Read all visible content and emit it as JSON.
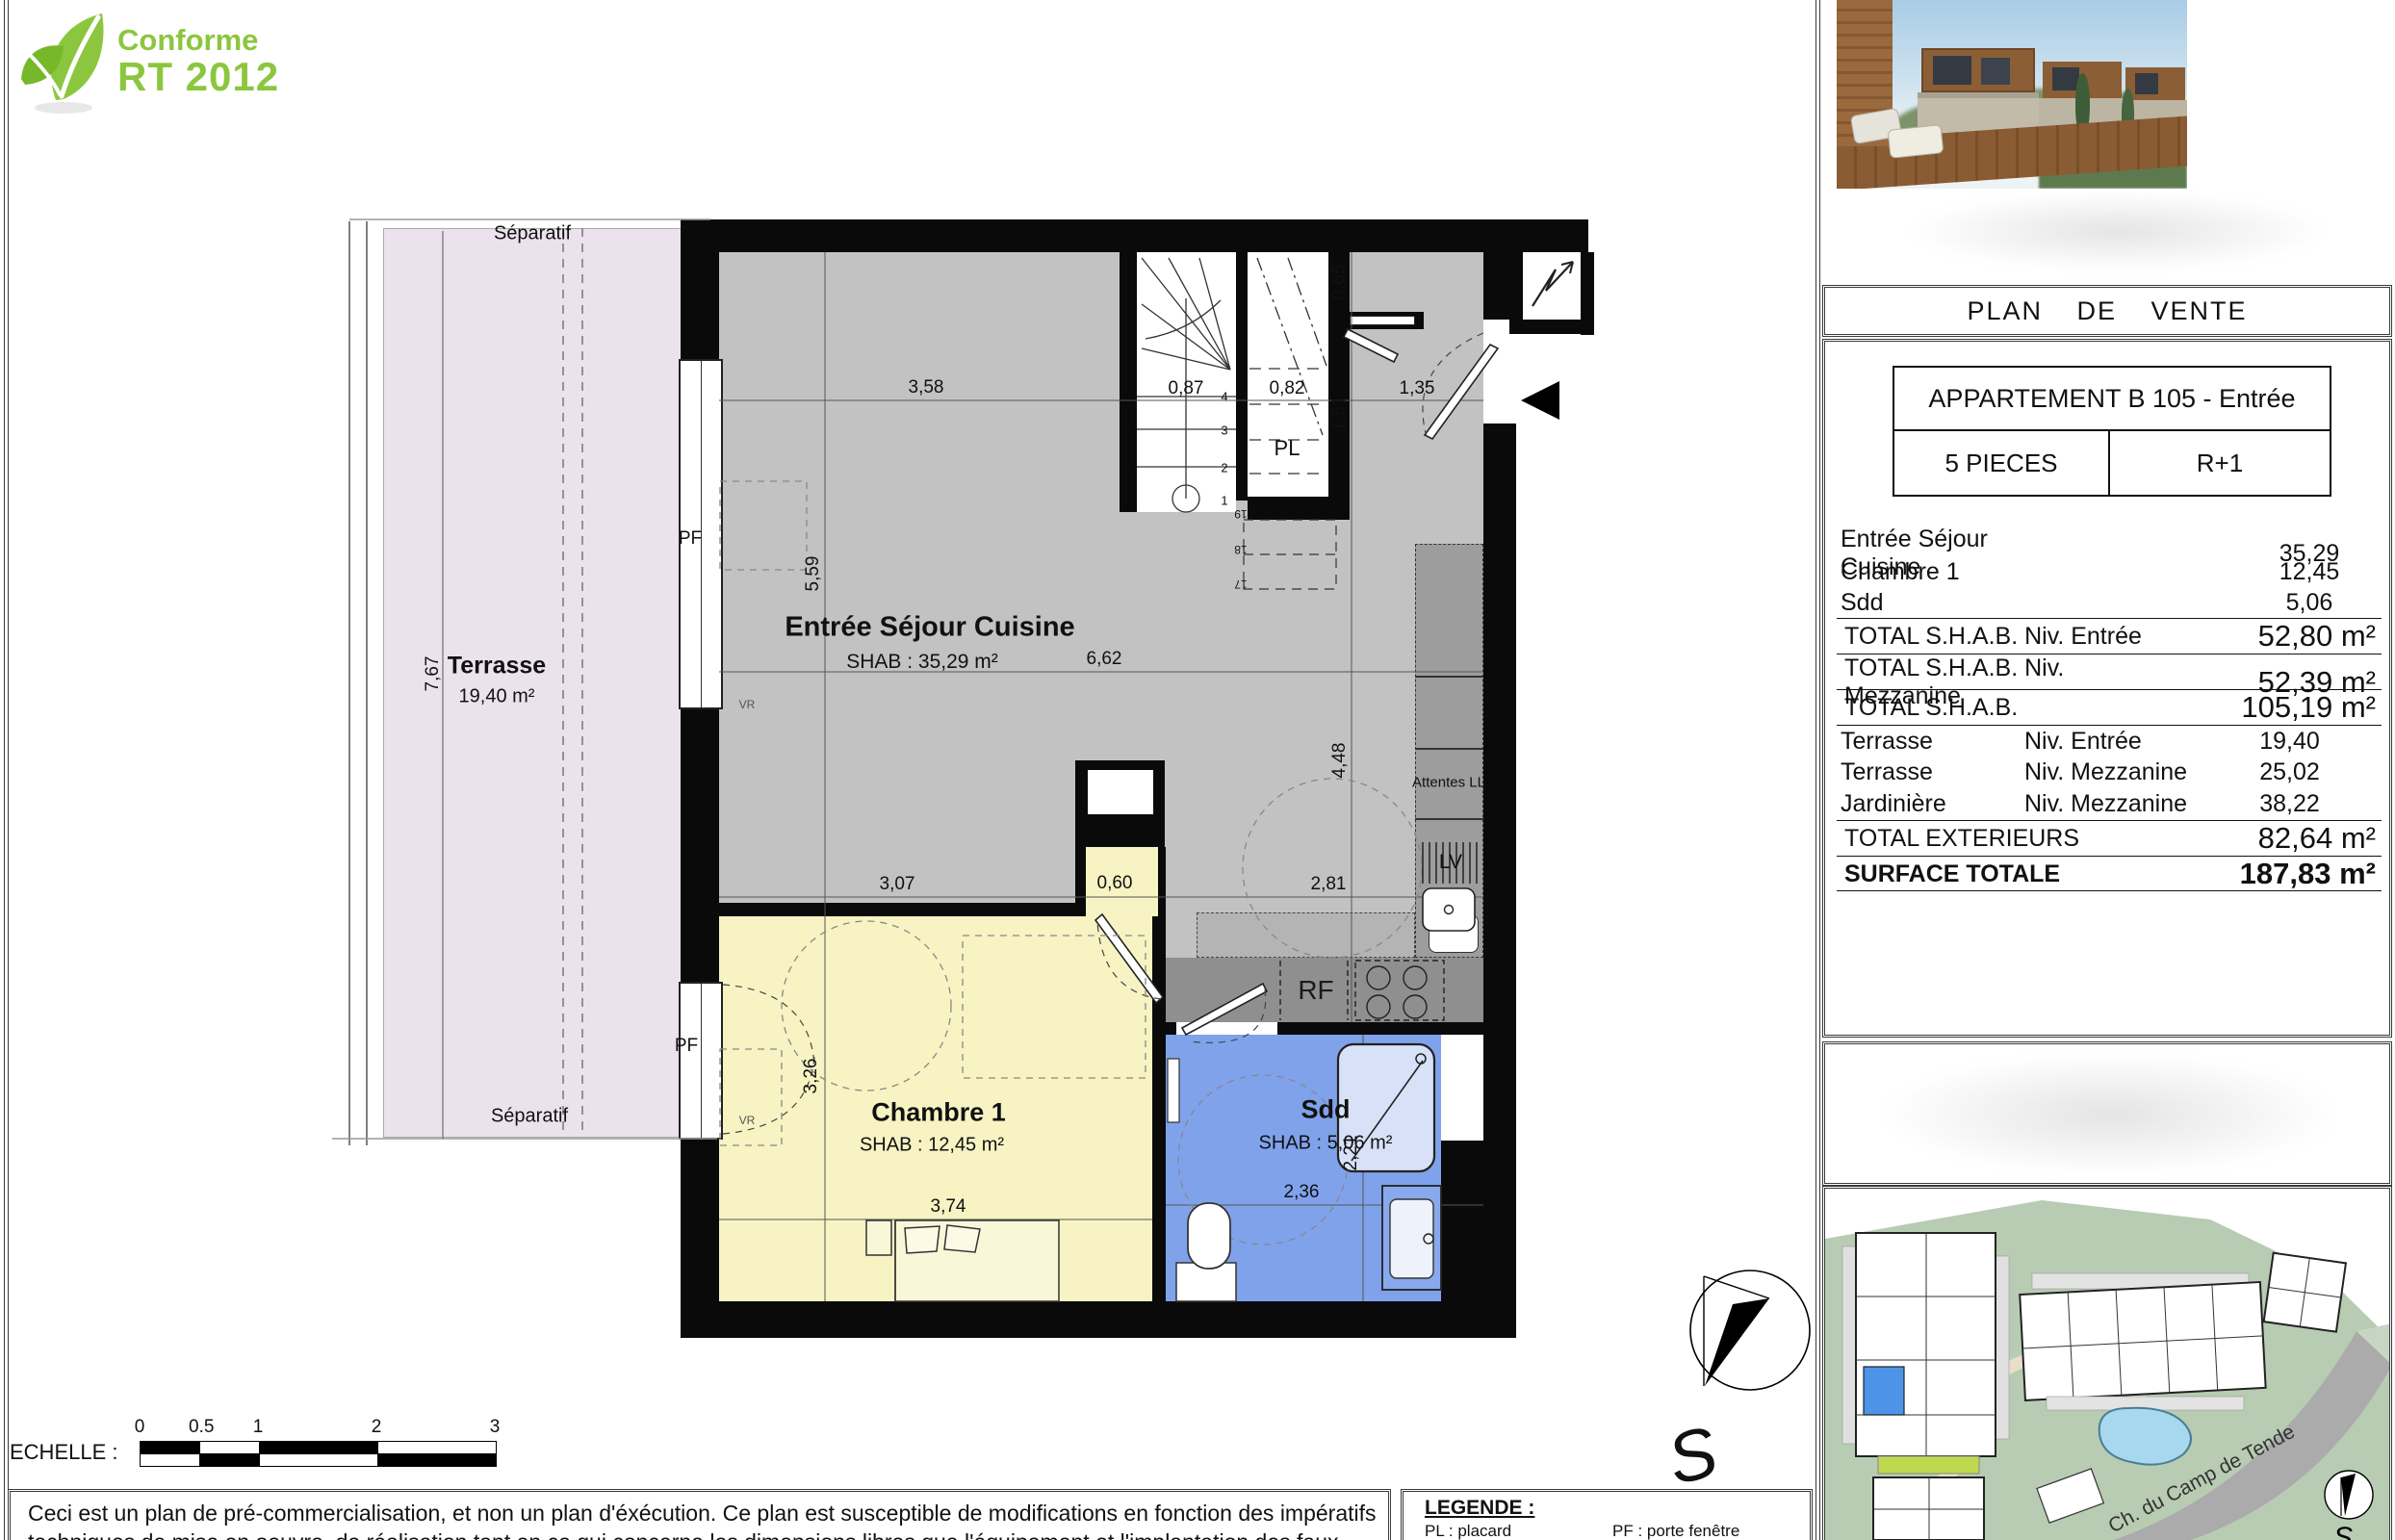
{
  "logo": {
    "line1": "Conforme",
    "line2": "RT 2012"
  },
  "plan": {
    "rooms": {
      "terrasse": {
        "name": "Terrasse",
        "area": "19,40 m²"
      },
      "sejour": {
        "name": "Entrée Séjour Cuisine",
        "shab": "SHAB : 35,29 m²"
      },
      "chambre": {
        "name": "Chambre 1",
        "shab": "SHAB : 12,45 m²"
      },
      "sdd": {
        "name": "Sdd",
        "shab": "SHAB : 5,06 m²"
      }
    },
    "labels": {
      "separatif_top": "Séparatif",
      "separatif_bottom": "Séparatif",
      "pl": "PL",
      "rf": "RF",
      "attentes_ll": "Attentes LL",
      "lv": "LV",
      "pf_sejour": "PF",
      "vr_sejour": "VR",
      "pf_chambre": "PF",
      "vr_chambre": "VR",
      "stairs": [
        "1",
        "2",
        "3",
        "4"
      ],
      "mezzanine_steps": [
        "19",
        "18",
        "17"
      ]
    },
    "dims": [
      "3,58",
      "0,87",
      "0,82",
      "1,35",
      "0,65",
      "1,51",
      "5,59",
      "6,62",
      "4,48",
      "3,07",
      "0,60",
      "2,81",
      "3,26",
      "3,74",
      "2,36",
      "2,21",
      "7,67"
    ]
  },
  "panel": {
    "title": "PLAN DE VENTE",
    "apartment": "APPARTEMENT B 105 - Entrée",
    "pieces": "5 PIECES",
    "level": "R+1",
    "table": {
      "rows": [
        {
          "label": "Entrée Séjour Cuisine",
          "mid": "",
          "value": "35,29"
        },
        {
          "label": "Chambre 1",
          "mid": "",
          "value": "12,45"
        },
        {
          "label": "Sdd",
          "mid": "",
          "value": "5,06"
        },
        {
          "label": "TOTAL S.H.A.B. Niv. Entrée",
          "value": "52,80 m²"
        },
        {
          "label": "TOTAL S.H.A.B. Niv. Mezzanine",
          "value": "52,39 m²"
        },
        {
          "label": "TOTAL S.H.A.B.",
          "value": "105,19 m²"
        },
        {
          "label": "Terrasse",
          "mid": "Niv. Entrée",
          "value": "19,40"
        },
        {
          "label": "Terrasse",
          "mid": "Niv. Mezzanine",
          "value": "25,02"
        },
        {
          "label": "Jardinière",
          "mid": "Niv. Mezzanine",
          "value": "38,22"
        },
        {
          "label": "TOTAL EXTERIEURS",
          "value": "82,64 m²"
        },
        {
          "label": "SURFACE TOTALE",
          "value": "187,83 m²"
        }
      ]
    }
  },
  "compass": {
    "south": "S"
  },
  "site": {
    "street": "Ch. du Camp de Tende",
    "compass_s": "S"
  },
  "scale": {
    "label": "ECHELLE :",
    "ticks": [
      "0",
      "0.5",
      "1",
      "2",
      "3"
    ]
  },
  "disclaimer": {
    "line1": "Ceci est un plan de pré-commercialisation, et non un plan d'éxécution. Ce plan est susceptible de modifications en fonction des impératifs",
    "line2": "techniques de mise en oeuvre, de réalisation tant en ce qui concerne les dimensions libres que l'équipement et l'implantation des faux-plafonds."
  },
  "legend": {
    "title": "LEGENDE :",
    "col1": [
      "PL : placard",
      "LL : lave-linge"
    ],
    "col2": [
      "PF : porte fenêtre",
      "F : fenêtre"
    ]
  },
  "colors": {
    "terrasse": "#ECE2EE",
    "sejour": "#C2C2C2",
    "kitchen": "#8F8F8F",
    "chambre": "#F7F3C3",
    "sdd": "#7FA2EB",
    "logo_green": "#8CC63E",
    "site_green": "#B7CCB2",
    "pool": "#A8D8EE",
    "unit_blue": "#4D94E8",
    "unit_lime": "#C0D84E"
  }
}
